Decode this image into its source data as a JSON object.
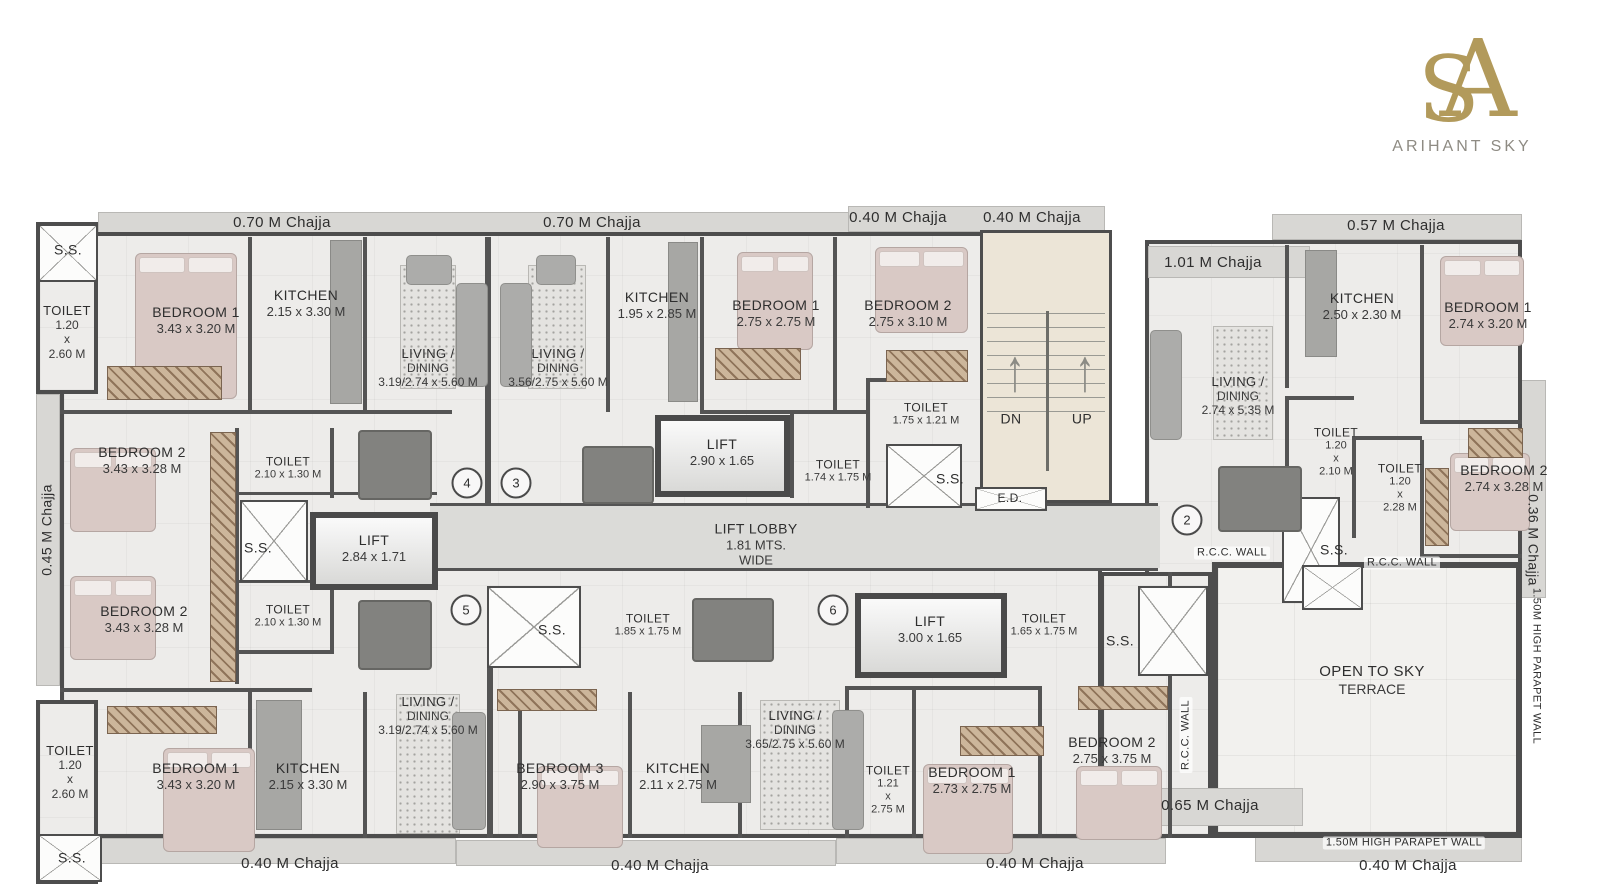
{
  "brand": {
    "name": "ARIHANT SKY",
    "monogram_a": "A",
    "monogram_s": "S"
  },
  "colors": {
    "logo_gold": "#b29a5b",
    "wall": "#545454",
    "floor": "#edecea",
    "chajja": "#d8d7d4",
    "stairs": "#ece5d7",
    "terrace": "#f2f1ee",
    "lobby": "#dbdbd8",
    "bed": "#d9c9c5"
  },
  "stairs": {
    "down_label": "DN",
    "up_label": "UP"
  },
  "labels": [
    {
      "id": "chajja-top-1",
      "t": "0.70 M Chajja",
      "x": 282,
      "y": 223,
      "fs": 15
    },
    {
      "id": "chajja-top-2",
      "t": "0.70 M Chajja",
      "x": 592,
      "y": 223,
      "fs": 15
    },
    {
      "id": "chajja-top-3",
      "t": "0.40 M Chajja",
      "x": 898,
      "y": 218,
      "fs": 15
    },
    {
      "id": "chajja-top-4",
      "t": "0.40 M Chajja",
      "x": 1032,
      "y": 218,
      "fs": 15
    },
    {
      "id": "chajja-top-right",
      "t": "0.57 M Chajja",
      "x": 1396,
      "y": 226,
      "fs": 15
    },
    {
      "id": "chajja-right-upper",
      "t": "1.01 M Chajja",
      "x": 1213,
      "y": 263,
      "fs": 15
    },
    {
      "id": "chajja-left-vertical",
      "t": "0.45 M Chajja",
      "x": 47,
      "y": 530,
      "fs": 14,
      "rot": -90
    },
    {
      "id": "chajja-right-vertical",
      "t": "0.36 M Chajja",
      "x": 1533,
      "y": 540,
      "fs": 14,
      "rot": 90
    },
    {
      "id": "ss-top-left",
      "t": "S.S.",
      "x": 68,
      "y": 250,
      "fs": 14
    },
    {
      "id": "toilet-top-left",
      "t": "TOILET",
      "d": [
        "1.20",
        "x",
        "2.60 M"
      ],
      "x": 67,
      "y": 332,
      "fs": 13
    },
    {
      "id": "bedroom1-top-left",
      "t": "BEDROOM 1",
      "d": [
        "3.43 x 3.20 M"
      ],
      "x": 196,
      "y": 320,
      "fs": 14
    },
    {
      "id": "kitchen-top-left",
      "t": "KITCHEN",
      "d": [
        "2.15 x 3.30 M"
      ],
      "x": 306,
      "y": 303,
      "fs": 14
    },
    {
      "id": "living-top-1",
      "t": "LIVING /",
      "d": [
        "DINING",
        "3.19/2.74 x 5.60 M"
      ],
      "x": 428,
      "y": 368,
      "fs": 13
    },
    {
      "id": "living-top-2",
      "t": "LIVING /",
      "d": [
        "DINING",
        "3.56/2.75 x 5.60 M"
      ],
      "x": 558,
      "y": 368,
      "fs": 13
    },
    {
      "id": "kitchen-top-2",
      "t": "KITCHEN",
      "d": [
        "1.95 x 2.85 M"
      ],
      "x": 657,
      "y": 305,
      "fs": 14
    },
    {
      "id": "bedroom1-top",
      "t": "BEDROOM 1",
      "d": [
        "2.75 x 2.75 M"
      ],
      "x": 776,
      "y": 313,
      "fs": 14
    },
    {
      "id": "bedroom2-top",
      "t": "BEDROOM 2",
      "d": [
        "2.75 x 3.10 M"
      ],
      "x": 908,
      "y": 313,
      "fs": 14
    },
    {
      "id": "toilet-top",
      "t": "TOILET",
      "d": [
        "1.75 x 1.21 M"
      ],
      "x": 926,
      "y": 414,
      "fs": 12
    },
    {
      "id": "stairs-dn",
      "t": "DN",
      "x": 1011,
      "y": 419,
      "fs": 14
    },
    {
      "id": "stairs-up",
      "t": "UP",
      "x": 1082,
      "y": 419,
      "fs": 14
    },
    {
      "id": "lift-top",
      "t": "LIFT",
      "d": [
        "2.90  x 1.65"
      ],
      "x": 722,
      "y": 452,
      "fs": 14
    },
    {
      "id": "toilet-mid",
      "t": "TOILET",
      "d": [
        "1.74 x 1.75 M"
      ],
      "x": 838,
      "y": 471,
      "fs": 12
    },
    {
      "id": "ss-stairs",
      "t": "S.S.",
      "x": 950,
      "y": 479,
      "fs": 14
    },
    {
      "id": "ed-duct",
      "t": "E.D.",
      "x": 1010,
      "y": 498,
      "fs": 12
    },
    {
      "id": "bedroom2-left-1",
      "t": "BEDROOM 2",
      "d": [
        "3.43 x 3.28 M"
      ],
      "x": 142,
      "y": 460,
      "fs": 14
    },
    {
      "id": "toilet-left-1",
      "t": "TOILET",
      "d": [
        "2.10 x 1.30 M"
      ],
      "x": 288,
      "y": 468,
      "fs": 12
    },
    {
      "id": "ss-left-mid",
      "t": "S.S.",
      "x": 258,
      "y": 548,
      "fs": 14
    },
    {
      "id": "lift-left",
      "t": "LIFT",
      "d": [
        "2.84  x 1.71"
      ],
      "x": 374,
      "y": 548,
      "fs": 14
    },
    {
      "id": "bedroom2-left-2",
      "t": "BEDROOM 2",
      "d": [
        "3.43 x 3.28 M"
      ],
      "x": 144,
      "y": 619,
      "fs": 14
    },
    {
      "id": "toilet-left-2",
      "t": "TOILET",
      "d": [
        "2.10 x 1.30 M"
      ],
      "x": 288,
      "y": 616,
      "fs": 12
    },
    {
      "id": "flat-4",
      "t": "4",
      "x": 467,
      "y": 483,
      "kind": "circle"
    },
    {
      "id": "flat-3",
      "t": "3",
      "x": 516,
      "y": 483,
      "kind": "circle"
    },
    {
      "id": "lift-lobby",
      "t": "LIFT LOBBY",
      "d": [
        "1.81 MTS.",
        "WIDE"
      ],
      "x": 756,
      "y": 544,
      "fs": 14
    },
    {
      "id": "flat-5",
      "t": "5",
      "x": 466,
      "y": 610,
      "kind": "circle"
    },
    {
      "id": "flat-6",
      "t": "6",
      "x": 833,
      "y": 610,
      "kind": "circle"
    },
    {
      "id": "ss-center-1",
      "t": "S.S.",
      "x": 552,
      "y": 630,
      "fs": 14
    },
    {
      "id": "toilet-center-1",
      "t": "TOILET",
      "d": [
        "1.85 x 1.75 M"
      ],
      "x": 648,
      "y": 625,
      "fs": 12
    },
    {
      "id": "lift-bottom",
      "t": "LIFT",
      "d": [
        "3.00  x 1.65"
      ],
      "x": 930,
      "y": 629,
      "fs": 14
    },
    {
      "id": "toilet-center-2",
      "t": "TOILET",
      "d": [
        "1.65 x 1.75 M"
      ],
      "x": 1044,
      "y": 625,
      "fs": 12
    },
    {
      "id": "ss-center-2",
      "t": "S.S.",
      "x": 1120,
      "y": 641,
      "fs": 14
    },
    {
      "id": "toilet-bottom-left",
      "t": "TOILET",
      "d": [
        "1.20",
        "x",
        "2.60 M"
      ],
      "x": 70,
      "y": 772,
      "fs": 13
    },
    {
      "id": "bedroom1-bottom-left",
      "t": "BEDROOM 1",
      "d": [
        "3.43 x 3.20 M"
      ],
      "x": 196,
      "y": 776,
      "fs": 14
    },
    {
      "id": "kitchen-bottom-left",
      "t": "KITCHEN",
      "d": [
        "2.15 x 3.30 M"
      ],
      "x": 308,
      "y": 776,
      "fs": 14
    },
    {
      "id": "ss-bottom-left",
      "t": "S.S.",
      "x": 72,
      "y": 858,
      "fs": 14
    },
    {
      "id": "living-bottom-1",
      "t": "LIVING /",
      "d": [
        "DINING",
        "3.19/2.74 x 5.60 M"
      ],
      "x": 428,
      "y": 716,
      "fs": 13
    },
    {
      "id": "bedroom3-bottom",
      "t": "BEDROOM 3",
      "d": [
        "2.90 x 3.75 M"
      ],
      "x": 560,
      "y": 776,
      "fs": 14
    },
    {
      "id": "kitchen-bottom-center",
      "t": "KITCHEN",
      "d": [
        "2.11 x 2.75 M"
      ],
      "x": 678,
      "y": 776,
      "fs": 14
    },
    {
      "id": "living-bottom-2",
      "t": "LIVING /",
      "d": [
        "DINING",
        "3.65/2.75 x 5.60 M"
      ],
      "x": 795,
      "y": 730,
      "fs": 13
    },
    {
      "id": "toilet-bottom-center",
      "t": "TOILET",
      "d": [
        "1.21",
        "x",
        "2.75 M"
      ],
      "x": 888,
      "y": 790,
      "fs": 12
    },
    {
      "id": "bedroom1-bottom-center",
      "t": "BEDROOM 1",
      "d": [
        "2.73 x 2.75 M"
      ],
      "x": 972,
      "y": 780,
      "fs": 14
    },
    {
      "id": "bedroom2-bottom-center",
      "t": "BEDROOM 2",
      "d": [
        "2.75 x 3.75 M"
      ],
      "x": 1112,
      "y": 750,
      "fs": 14
    },
    {
      "id": "rcc-wall-vertical",
      "t": "R.C.C. WALL",
      "x": 1186,
      "y": 735,
      "fs": 11,
      "rot": -90,
      "kind": "tag"
    },
    {
      "id": "kitchen-right",
      "t": "KITCHEN",
      "d": [
        "2.50 x 2.30 M"
      ],
      "x": 1362,
      "y": 306,
      "fs": 14
    },
    {
      "id": "bedroom1-right",
      "t": "BEDROOM 1",
      "d": [
        "2.74 x 3.20 M"
      ],
      "x": 1488,
      "y": 315,
      "fs": 14
    },
    {
      "id": "living-right",
      "t": "LIVING /",
      "d": [
        "DINING",
        "2.74 x 5.35 M"
      ],
      "x": 1238,
      "y": 396,
      "fs": 13
    },
    {
      "id": "toilet-right-1",
      "t": "TOILET",
      "d": [
        "1.20",
        "x",
        "2.10 M"
      ],
      "x": 1336,
      "y": 452,
      "fs": 12
    },
    {
      "id": "toilet-right-2",
      "t": "TOILET",
      "d": [
        "1.20",
        "x",
        "2.28 M"
      ],
      "x": 1400,
      "y": 488,
      "fs": 12
    },
    {
      "id": "bedroom2-right",
      "t": "BEDROOM 2",
      "d": [
        "2.74 x 3.28 M"
      ],
      "x": 1504,
      "y": 478,
      "fs": 14
    },
    {
      "id": "ss-right",
      "t": "S.S.",
      "x": 1334,
      "y": 550,
      "fs": 14
    },
    {
      "id": "rcc-wall-h1",
      "t": "R.C.C. WALL",
      "x": 1232,
      "y": 553,
      "fs": 11,
      "kind": "tag"
    },
    {
      "id": "rcc-wall-h2",
      "t": "R.C.C. WALL",
      "x": 1402,
      "y": 563,
      "fs": 11,
      "kind": "tag"
    },
    {
      "id": "flat-2",
      "t": "2",
      "x": 1187,
      "y": 520,
      "kind": "circle"
    },
    {
      "id": "terrace-label",
      "t": "OPEN TO SKY",
      "d": [
        "TERRACE"
      ],
      "x": 1372,
      "y": 680,
      "fs": 15
    },
    {
      "id": "parapet-right-vertical",
      "t": "1.50M HIGH PARAPET WALL",
      "x": 1536,
      "y": 666,
      "fs": 11,
      "rot": 90
    },
    {
      "id": "chajja-bottom-65",
      "t": "0.65 M Chajja",
      "x": 1210,
      "y": 806,
      "fs": 15
    },
    {
      "id": "chajja-bottom-1",
      "t": "0.40 M Chajja",
      "x": 290,
      "y": 864,
      "fs": 15
    },
    {
      "id": "chajja-bottom-2",
      "t": "0.40 M Chajja",
      "x": 660,
      "y": 866,
      "fs": 15
    },
    {
      "id": "chajja-bottom-3",
      "t": "0.40 M Chajja",
      "x": 1035,
      "y": 864,
      "fs": 15
    },
    {
      "id": "parapet-bottom",
      "t": "1.50M HIGH PARAPET WALL",
      "x": 1404,
      "y": 843,
      "fs": 11,
      "kind": "tag"
    },
    {
      "id": "chajja-bottom-4",
      "t": "0.40 M Chajja",
      "x": 1408,
      "y": 866,
      "fs": 15
    }
  ]
}
